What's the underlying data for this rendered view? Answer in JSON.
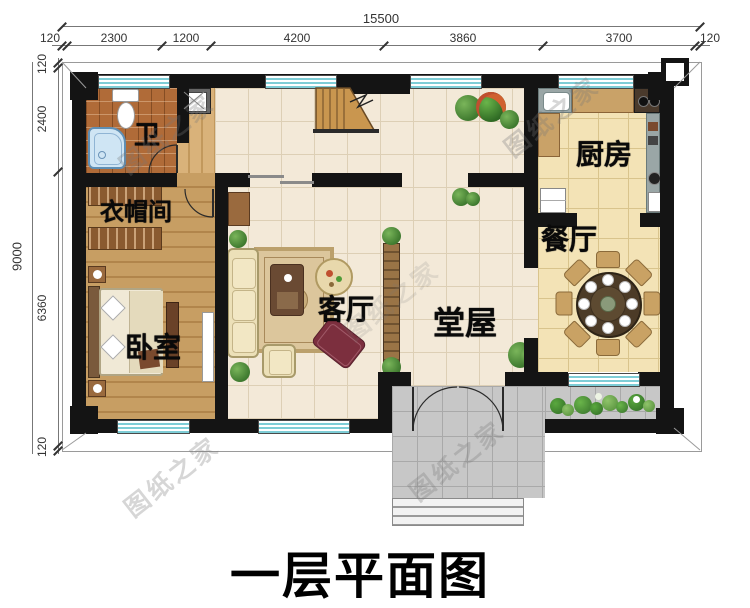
{
  "title": "一层平面图",
  "watermark_text": "图纸之家",
  "rooms": {
    "bath": "卫",
    "cloakroom": "衣帽间",
    "bedroom": "卧室",
    "living": "客厅",
    "hall": "堂屋",
    "kitchen": "厨房",
    "dining": "餐厅"
  },
  "dimensions": {
    "top": {
      "total": "15500",
      "segments": [
        "120",
        "2300",
        "1200",
        "4200",
        "3860",
        "3700",
        "120"
      ]
    },
    "left": {
      "total": "9000",
      "segments": [
        "120",
        "2400",
        "6360",
        "120"
      ]
    }
  },
  "colors": {
    "wall": "#141414",
    "window_stripe": "#7ecdd6",
    "tile_beige": "#f3e9d8",
    "tile_yellow": "#f3e3b6",
    "wood_floor": "#c79e63",
    "bath_tile": "#b06b38",
    "porch_gray": "#c7c7c7",
    "plant_green": "#4f9c37",
    "chaise_red": "#7c2f3e",
    "dining_table": "#4c3b27"
  }
}
